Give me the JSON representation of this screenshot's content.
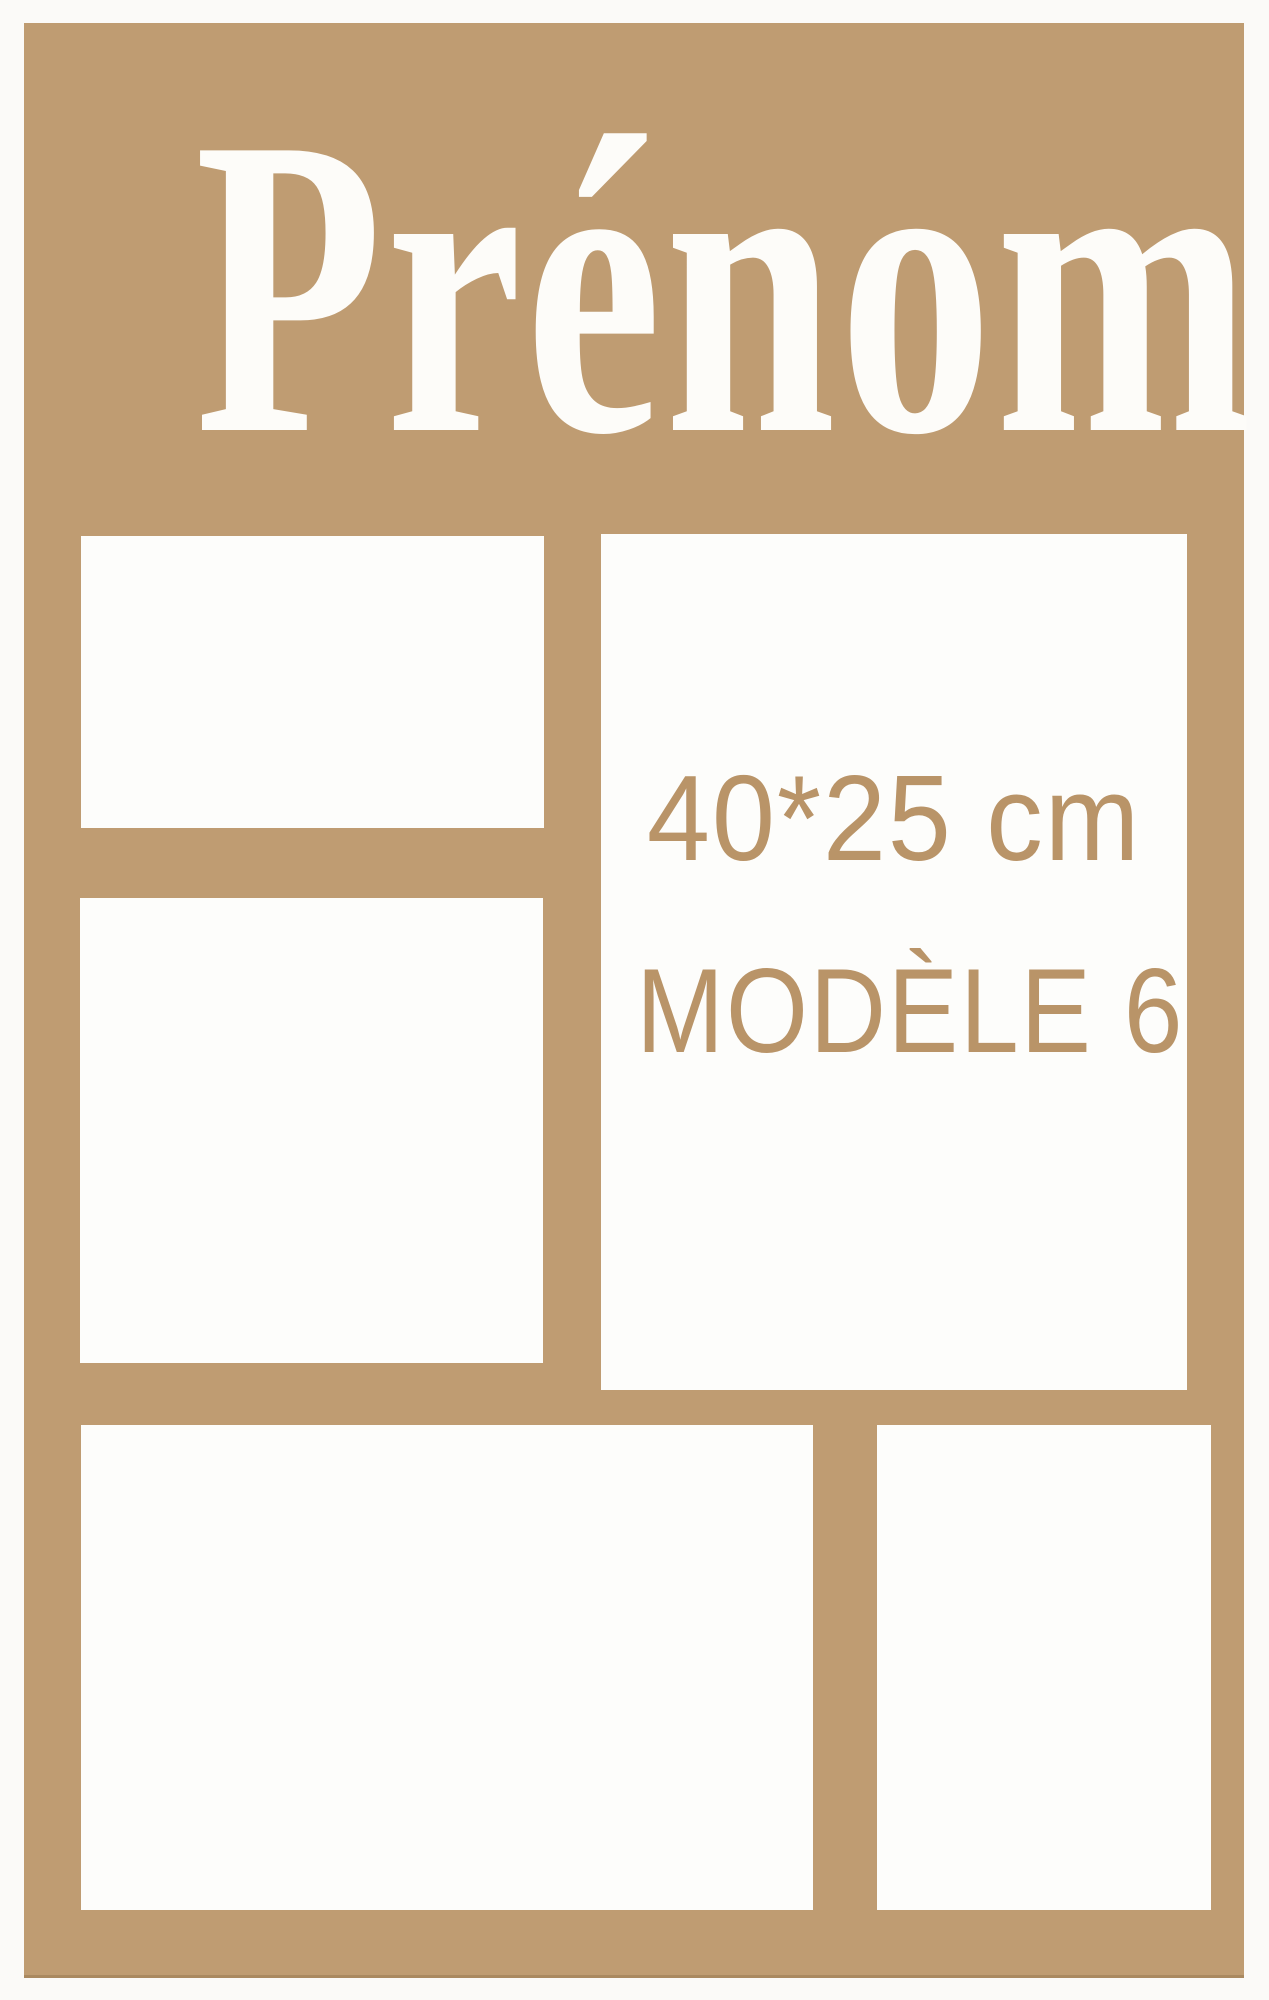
{
  "board": {
    "title": "Prénom",
    "size_label": "40*25 cm",
    "model_label": "MODÈLE 6"
  },
  "photo_slots": {
    "count": 5,
    "positions": [
      "top-left",
      "middle-left",
      "right-tall",
      "bottom-left",
      "bottom-right"
    ]
  },
  "colors": {
    "board_wood": "#bf9c72",
    "engraved_text": "#b99468",
    "cutout_white": "#fdfdfb",
    "page_background": "#fbfaf8",
    "title_white": "#fdfcf9"
  }
}
